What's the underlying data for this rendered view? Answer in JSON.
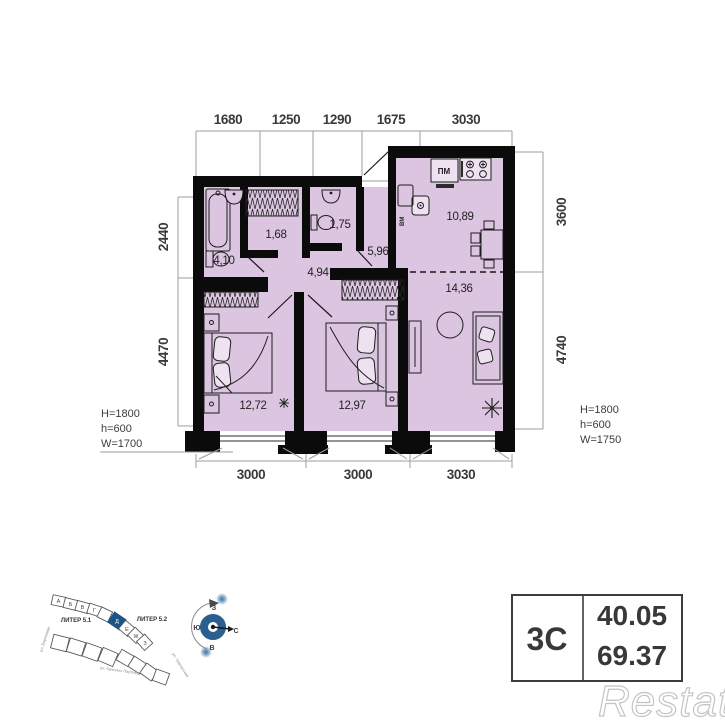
{
  "plan": {
    "dims_top": [
      "1680",
      "1250",
      "1290",
      "1675",
      "3030"
    ],
    "dims_bottom": [
      "3000",
      "3000",
      "3030"
    ],
    "dims_left": [
      "2440",
      "4470"
    ],
    "dims_right": [
      "3600",
      "4740"
    ],
    "window_left": [
      "H=1800",
      "h=600",
      "W=1700"
    ],
    "window_right": [
      "H=1800",
      "h=600",
      "W=1750"
    ],
    "rooms": {
      "bathroom": "4,10",
      "wardrobe": "1,68",
      "wc": "1,75",
      "hall_small": "4,94",
      "hallway": "5,96",
      "kitchen": "10,89",
      "living": "14,36",
      "bedroom1": "12,72",
      "bedroom2": "12,97"
    },
    "appliances": {
      "dishwasher": "ПМ",
      "washing_machine": "ВМ"
    }
  },
  "site_plan": {
    "liter_1": "ЛИТЕР 5.1",
    "liter_2": "ЛИТЕР 5.2",
    "blocks": [
      "А",
      "Б",
      "В",
      "Г",
      "Д",
      "Е",
      "Ж",
      "З"
    ],
    "highlighted_block": "Д",
    "streets": [
      "ул. Берёзовая",
      "ул. Красных Партизан",
      "ул. Черкасская"
    ]
  },
  "compass": {
    "west": "З",
    "south": "Ю",
    "north": "С",
    "east": "В"
  },
  "info_table": {
    "layout_type": "3С",
    "living_area": "40.05",
    "total_area": "69.37"
  },
  "watermark": "Restate",
  "colors": {
    "floor": "#dcc5e1",
    "wall": "#0b0b0b",
    "accent_blue": "#2b5f8e"
  }
}
